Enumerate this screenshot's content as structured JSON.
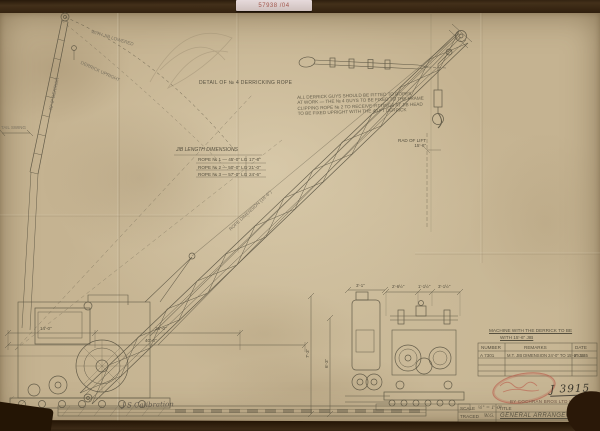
{
  "sticker": {
    "text": "57938 /04"
  },
  "drawing": {
    "rope_detail_label": "DETAIL OF № 4 DERRICKING ROPE",
    "notes_lines": [
      "ALL DERRICK GUYS SHOULD BE FITTED TO ROPES",
      "AT WORK — THE № 4 GUYS TO BE FIXED TO THE FRAME",
      "CLIPPING ROPE № 2 TO RECEIVE FITTINGS AT JIB HEAD",
      "TO BE FIXED UPRIGHT WITH THE 40 FT DERRICK"
    ],
    "jib_table": {
      "title": "JIB LENGTH DIMENSIONS",
      "rows": [
        {
          "item": "ROPE № 1 — 45'-0\" LG",
          "value": "17'-6\""
        },
        {
          "item": "ROPE № 2 — 50'-0\" LG",
          "value": "21'-0\""
        },
        {
          "item": "ROPE № 3 — 57'-0\" LG",
          "value": "24'-6\""
        }
      ]
    },
    "left_view": {
      "arc_label_upper": "WITH JIB LOWERED",
      "arc_label_lower": "DERRICK UPRIGHT",
      "mast_label": "40'-0\" DERRICK",
      "tail_label": "TAIL SWING",
      "dim_row1_a": "14'-0\"",
      "dim_row1_b": "26'-0\"",
      "dim_row2": "40'-0\""
    },
    "jib_rope_label": "ROPE DIMENSION (18'-6\")",
    "hook_dim_line1": "RAD OF LIFT",
    "hook_dim_line2": "15'-6\"",
    "end_views": {
      "dim_height_outer": "7'-3\"",
      "dim_height_inner": "6'-3\"",
      "dim_top_1": "3'-1\"",
      "dim_top_2": "2'-6½\"",
      "dim_top_3": "1'-1½\"",
      "dim_top_4": "3'-1½\""
    },
    "bottom_note": "J S Calibration"
  },
  "revisions": {
    "note_line1": "MACHINE WITH THE DERRICK TO BE",
    "note_line2": "WITH 15'-6\" JIB",
    "headers": [
      "NUMBER",
      "REMARKS",
      "DATE"
    ],
    "row1": {
      "number": "A 7301",
      "remarks": "M.T. JIB DIMENSION 24'-0\" TO 15'-6\" JIB",
      "date": "29.1.45"
    }
  },
  "stamp_ref": "J 3915",
  "maker_line": "BY COCHRAN BROS LTD HULL",
  "title_block": {
    "scale_label": "SCALE",
    "scale_value": "½\" = 1'-0\"",
    "traced_label": "TRACED",
    "traced_value": "W.G.",
    "checked_label": "CHECKED",
    "date_label": "DATE",
    "date_value": "2 · 45",
    "title_label": "TITLE",
    "title": "GENERAL ARRANGEMENT",
    "drg_label": "DRG №"
  },
  "colors": {
    "paper": "#c5b391",
    "ink": "#56503f",
    "stamp_red": "#ba5c4c",
    "wood": "#33220f"
  }
}
